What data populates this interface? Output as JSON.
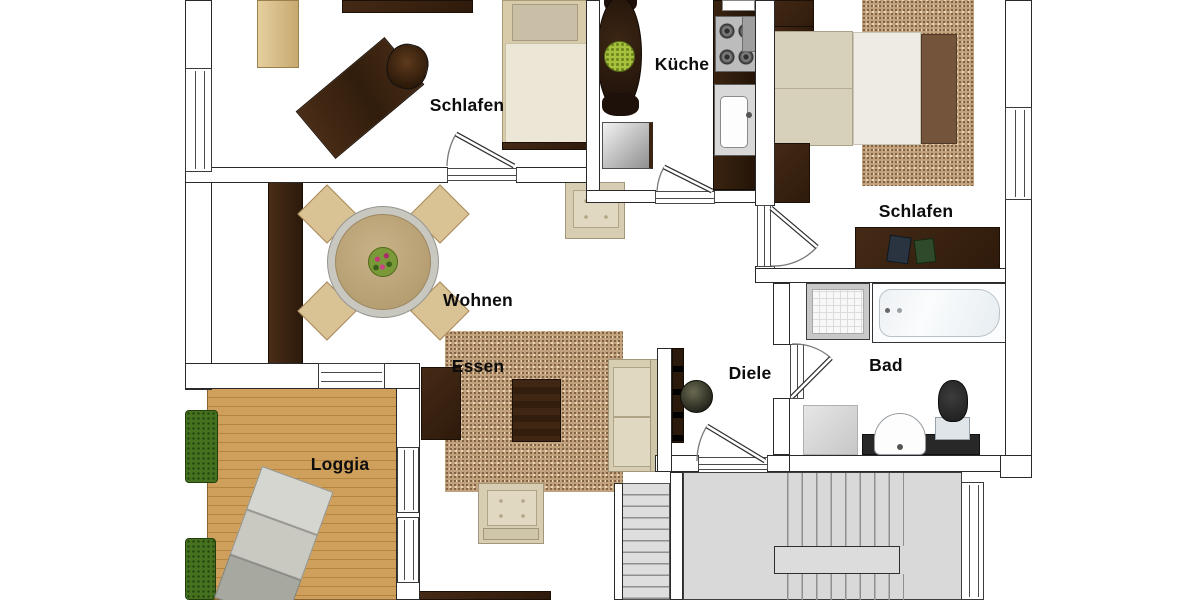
{
  "meta": {
    "type": "apartment-floor-plan",
    "language": "de",
    "orientation": "top-down"
  },
  "rooms": [
    {
      "id": "schlafen-1",
      "label": "Schlafen"
    },
    {
      "id": "kueche",
      "label": "Küche"
    },
    {
      "id": "schlafen-2",
      "label": "Schlafen"
    },
    {
      "id": "bad",
      "label": "Bad"
    },
    {
      "id": "diele",
      "label": "Diele"
    },
    {
      "id": "wohnen-essen",
      "label_line1": "Wohnen",
      "label_line2": "Essen"
    },
    {
      "id": "loggia",
      "label": "Loggia"
    }
  ],
  "palette": {
    "wall_outline": "#2a2a2a",
    "dark_wood": "#3a2414",
    "light_wood": "#dcc28c",
    "deck_wood": "#cfa05c",
    "upholstery": "#d7cdb2",
    "rug": "#c3a37d",
    "stairs": "#dcdcdc",
    "plant_green": "#46711f",
    "label_color": "#0d0d0d"
  },
  "furniture": [
    "single-bed",
    "desk",
    "office-chair",
    "wardrobes",
    "oval-dining-table",
    "fridge",
    "cooktop",
    "kitchen-sink",
    "kitchen-counter",
    "double-bed",
    "dresser",
    "rugs",
    "shower",
    "bathtub",
    "washbasin",
    "toilet",
    "washing-machine",
    "coat-rack",
    "round-dining-table",
    "dining-chairs",
    "sofa",
    "armchairs",
    "coffee-table",
    "tv-board",
    "sun-lounger",
    "planter-boxes",
    "u-staircase",
    "side-staircase"
  ]
}
